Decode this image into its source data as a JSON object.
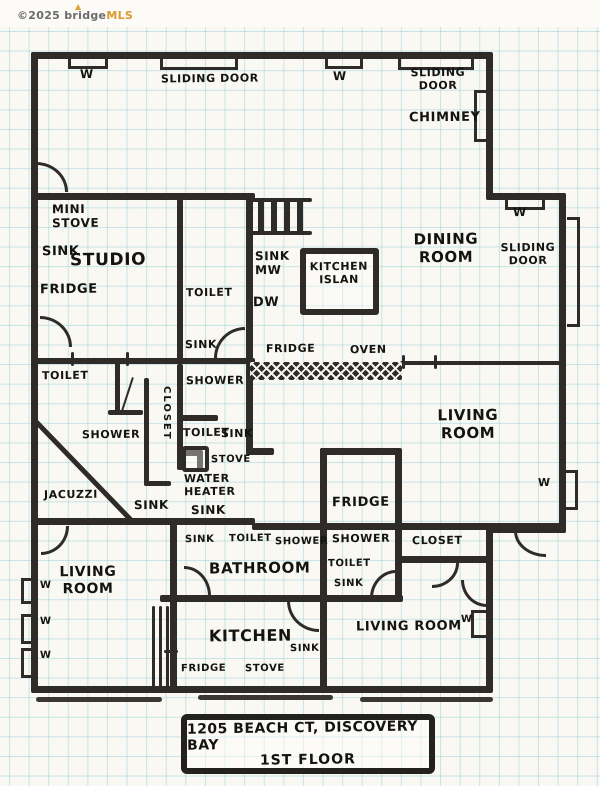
{
  "watermark": {
    "copyright_text": "©2025 bridge",
    "brand": "MLS",
    "flame_icon": "▲"
  },
  "title_box": {
    "line1": "1205 BEACH CT, DISCOVERY BAY",
    "line2": "1ST FLOOR"
  },
  "plan_title": "1205 Beach Ct, Discovery Bay — 1st Floor hand-drawn floor plan",
  "colors": {
    "wall": "#2e2b28",
    "paper": "#f9f8f3",
    "grid": "#7ac0d0",
    "brand_orange": "#d9992b",
    "ink": "#15130f"
  },
  "labels": [
    {
      "name": "label-window-top-left",
      "text": "W",
      "x": 80,
      "y": 67,
      "fs": 12
    },
    {
      "name": "label-sliding-door-top-left",
      "text": "SLIDING DOOR",
      "x": 161,
      "y": 73,
      "fs": 11
    },
    {
      "name": "label-window-top-mid",
      "text": "W",
      "x": 333,
      "y": 69,
      "fs": 12
    },
    {
      "name": "label-sliding-door-top-mid",
      "text": "SLIDING\nDOOR",
      "x": 400,
      "y": 67,
      "fs": 11,
      "center": true,
      "w": 76
    },
    {
      "name": "label-chimney",
      "text": "CHIMNEY",
      "x": 409,
      "y": 110,
      "fs": 13
    },
    {
      "name": "label-window-jog",
      "text": "W",
      "x": 513,
      "y": 205,
      "fs": 12
    },
    {
      "name": "label-sliding-door-right",
      "text": "SLIDING\nDOOR",
      "x": 498,
      "y": 242,
      "fs": 11,
      "center": true,
      "w": 60
    },
    {
      "name": "label-dining-room",
      "text": "DINING\nROOM",
      "x": 410,
      "y": 231,
      "fs": 15,
      "center": true,
      "w": 72
    },
    {
      "name": "label-mini-stove",
      "text": "MINI\nSTOVE",
      "x": 52,
      "y": 202,
      "fs": 12
    },
    {
      "name": "label-studio-sink",
      "text": "SINK",
      "x": 42,
      "y": 244,
      "fs": 13
    },
    {
      "name": "label-studio",
      "text": "STUDIO",
      "x": 70,
      "y": 250,
      "fs": 17
    },
    {
      "name": "label-studio-fridge",
      "text": "FRIDGE",
      "x": 40,
      "y": 282,
      "fs": 13
    },
    {
      "name": "label-toilet-center",
      "text": "TOILET",
      "x": 186,
      "y": 287,
      "fs": 11
    },
    {
      "name": "label-sink-mw",
      "text": "SINK\nMW",
      "x": 255,
      "y": 249,
      "fs": 12
    },
    {
      "name": "label-dw",
      "text": "DW",
      "x": 253,
      "y": 295,
      "fs": 13
    },
    {
      "name": "label-kitchen-island",
      "text": "KITCHEN\nISLAN",
      "x": 300,
      "y": 261,
      "fs": 11,
      "center": true,
      "w": 78
    },
    {
      "name": "label-sink-mid-left",
      "text": "SINK",
      "x": 185,
      "y": 339,
      "fs": 11
    },
    {
      "name": "label-fridge-counter",
      "text": "FRIDGE",
      "x": 266,
      "y": 343,
      "fs": 11
    },
    {
      "name": "label-oven",
      "text": "OVEN",
      "x": 350,
      "y": 344,
      "fs": 11
    },
    {
      "name": "label-toilet-left",
      "text": "TOILET",
      "x": 42,
      "y": 370,
      "fs": 11
    },
    {
      "name": "label-shower-mid",
      "text": "SHOWER",
      "x": 186,
      "y": 375,
      "fs": 11
    },
    {
      "name": "label-closet-vertical",
      "text": "CLOSET",
      "x": 172,
      "y": 386,
      "fs": 10,
      "vertical": true
    },
    {
      "name": "label-shower-left",
      "text": "SHOWER",
      "x": 82,
      "y": 429,
      "fs": 11
    },
    {
      "name": "label-toilet-mid",
      "text": "TOILET",
      "x": 183,
      "y": 427,
      "fs": 11
    },
    {
      "name": "label-sink-mid",
      "text": "SINK",
      "x": 221,
      "y": 428,
      "fs": 11
    },
    {
      "name": "label-stove-mid",
      "text": "STOVE",
      "x": 211,
      "y": 454,
      "fs": 10
    },
    {
      "name": "label-water-heater",
      "text": "WATER\nHEATER",
      "x": 184,
      "y": 473,
      "fs": 11
    },
    {
      "name": "label-jacuzzi",
      "text": "JACUZZI",
      "x": 44,
      "y": 489,
      "fs": 11
    },
    {
      "name": "label-sink-jacuzzi",
      "text": "SINK",
      "x": 134,
      "y": 498,
      "fs": 12
    },
    {
      "name": "label-sink-water-heater",
      "text": "SINK",
      "x": 191,
      "y": 503,
      "fs": 12
    },
    {
      "name": "label-living-room-right",
      "text": "LIVING\nROOM",
      "x": 436,
      "y": 407,
      "fs": 15,
      "center": true,
      "w": 64
    },
    {
      "name": "label-window-right",
      "text": "W",
      "x": 538,
      "y": 477,
      "fs": 11
    },
    {
      "name": "label-fridge-room",
      "text": "FRIDGE",
      "x": 332,
      "y": 495,
      "fs": 13
    },
    {
      "name": "label-bathroom-sink",
      "text": "SINK",
      "x": 185,
      "y": 534,
      "fs": 10
    },
    {
      "name": "label-bathroom-toilet",
      "text": "TOILET",
      "x": 229,
      "y": 533,
      "fs": 10
    },
    {
      "name": "label-bathroom-shower",
      "text": "SHOWER",
      "x": 275,
      "y": 536,
      "fs": 10
    },
    {
      "name": "label-shower-room-shower",
      "text": "SHOWER",
      "x": 332,
      "y": 533,
      "fs": 11
    },
    {
      "name": "label-closet-right",
      "text": "CLOSET",
      "x": 412,
      "y": 535,
      "fs": 11
    },
    {
      "name": "label-bathroom",
      "text": "BATHROOM",
      "x": 209,
      "y": 560,
      "fs": 15
    },
    {
      "name": "label-shower-room-toilet",
      "text": "TOILET",
      "x": 328,
      "y": 558,
      "fs": 10
    },
    {
      "name": "label-shower-room-sink",
      "text": "SINK",
      "x": 334,
      "y": 578,
      "fs": 10
    },
    {
      "name": "label-living-room-left",
      "text": "LIVING\nROOM",
      "x": 56,
      "y": 564,
      "fs": 14,
      "center": true,
      "w": 64
    },
    {
      "name": "label-window-left-1",
      "text": "W",
      "x": 40,
      "y": 580,
      "fs": 10
    },
    {
      "name": "label-window-left-2",
      "text": "W",
      "x": 40,
      "y": 616,
      "fs": 10
    },
    {
      "name": "label-window-left-3",
      "text": "W",
      "x": 40,
      "y": 650,
      "fs": 10
    },
    {
      "name": "label-kitchen",
      "text": "KITCHEN",
      "x": 209,
      "y": 627,
      "fs": 16
    },
    {
      "name": "label-kitchen-sink",
      "text": "SINK",
      "x": 290,
      "y": 643,
      "fs": 10
    },
    {
      "name": "label-living-room-bottom-right",
      "text": "LIVING ROOM",
      "x": 356,
      "y": 619,
      "fs": 13
    },
    {
      "name": "label-window-bottom-right",
      "text": "W",
      "x": 461,
      "y": 614,
      "fs": 10
    },
    {
      "name": "label-kitchen-fridge",
      "text": "FRIDGE",
      "x": 181,
      "y": 663,
      "fs": 10
    },
    {
      "name": "label-kitchen-stove",
      "text": "STOVE",
      "x": 245,
      "y": 663,
      "fs": 10
    }
  ]
}
